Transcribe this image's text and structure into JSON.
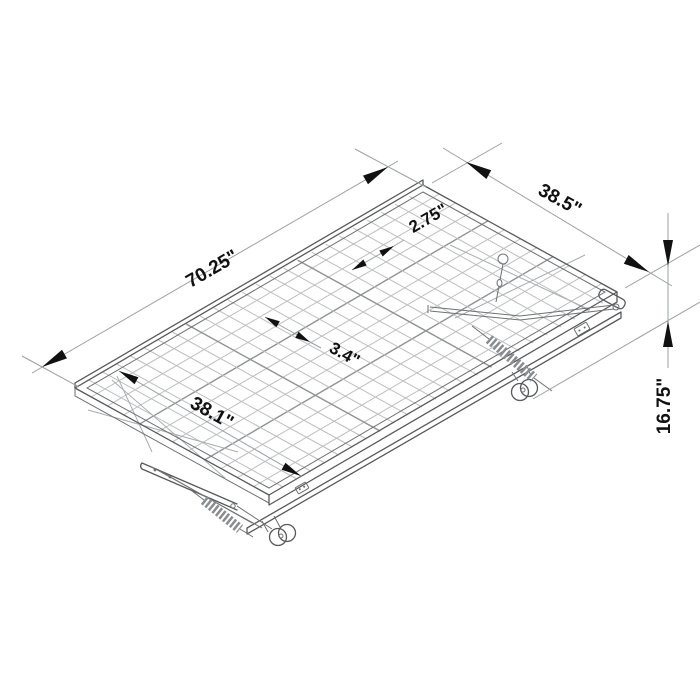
{
  "figure": {
    "type": "product-dimension-line-drawing",
    "subject": "folding trundle bed frame with wire mesh deck, X-fold legs and casters",
    "background_color": "#ffffff",
    "frame_line_color": "#58595b",
    "mesh_wire_color": "#bcbec0",
    "dimension_line_color": "#9aa0a3",
    "annotation_color": "#111111"
  },
  "dimensions": {
    "length": {
      "label": "70.25\"",
      "meaning": "overall frame length"
    },
    "width": {
      "label": "38.5\"",
      "meaning": "overall frame width"
    },
    "height": {
      "label": "16.75\"",
      "meaning": "overall height floor to deck"
    },
    "wire_spacing_long": {
      "label": "2.75\"",
      "meaning": "mesh wire spacing along length"
    },
    "wire_spacing_cross": {
      "label": "3.4\"",
      "meaning": "mesh wire spacing across width"
    },
    "inner_width": {
      "label": "38.1\"",
      "meaning": "inner deck width"
    }
  }
}
